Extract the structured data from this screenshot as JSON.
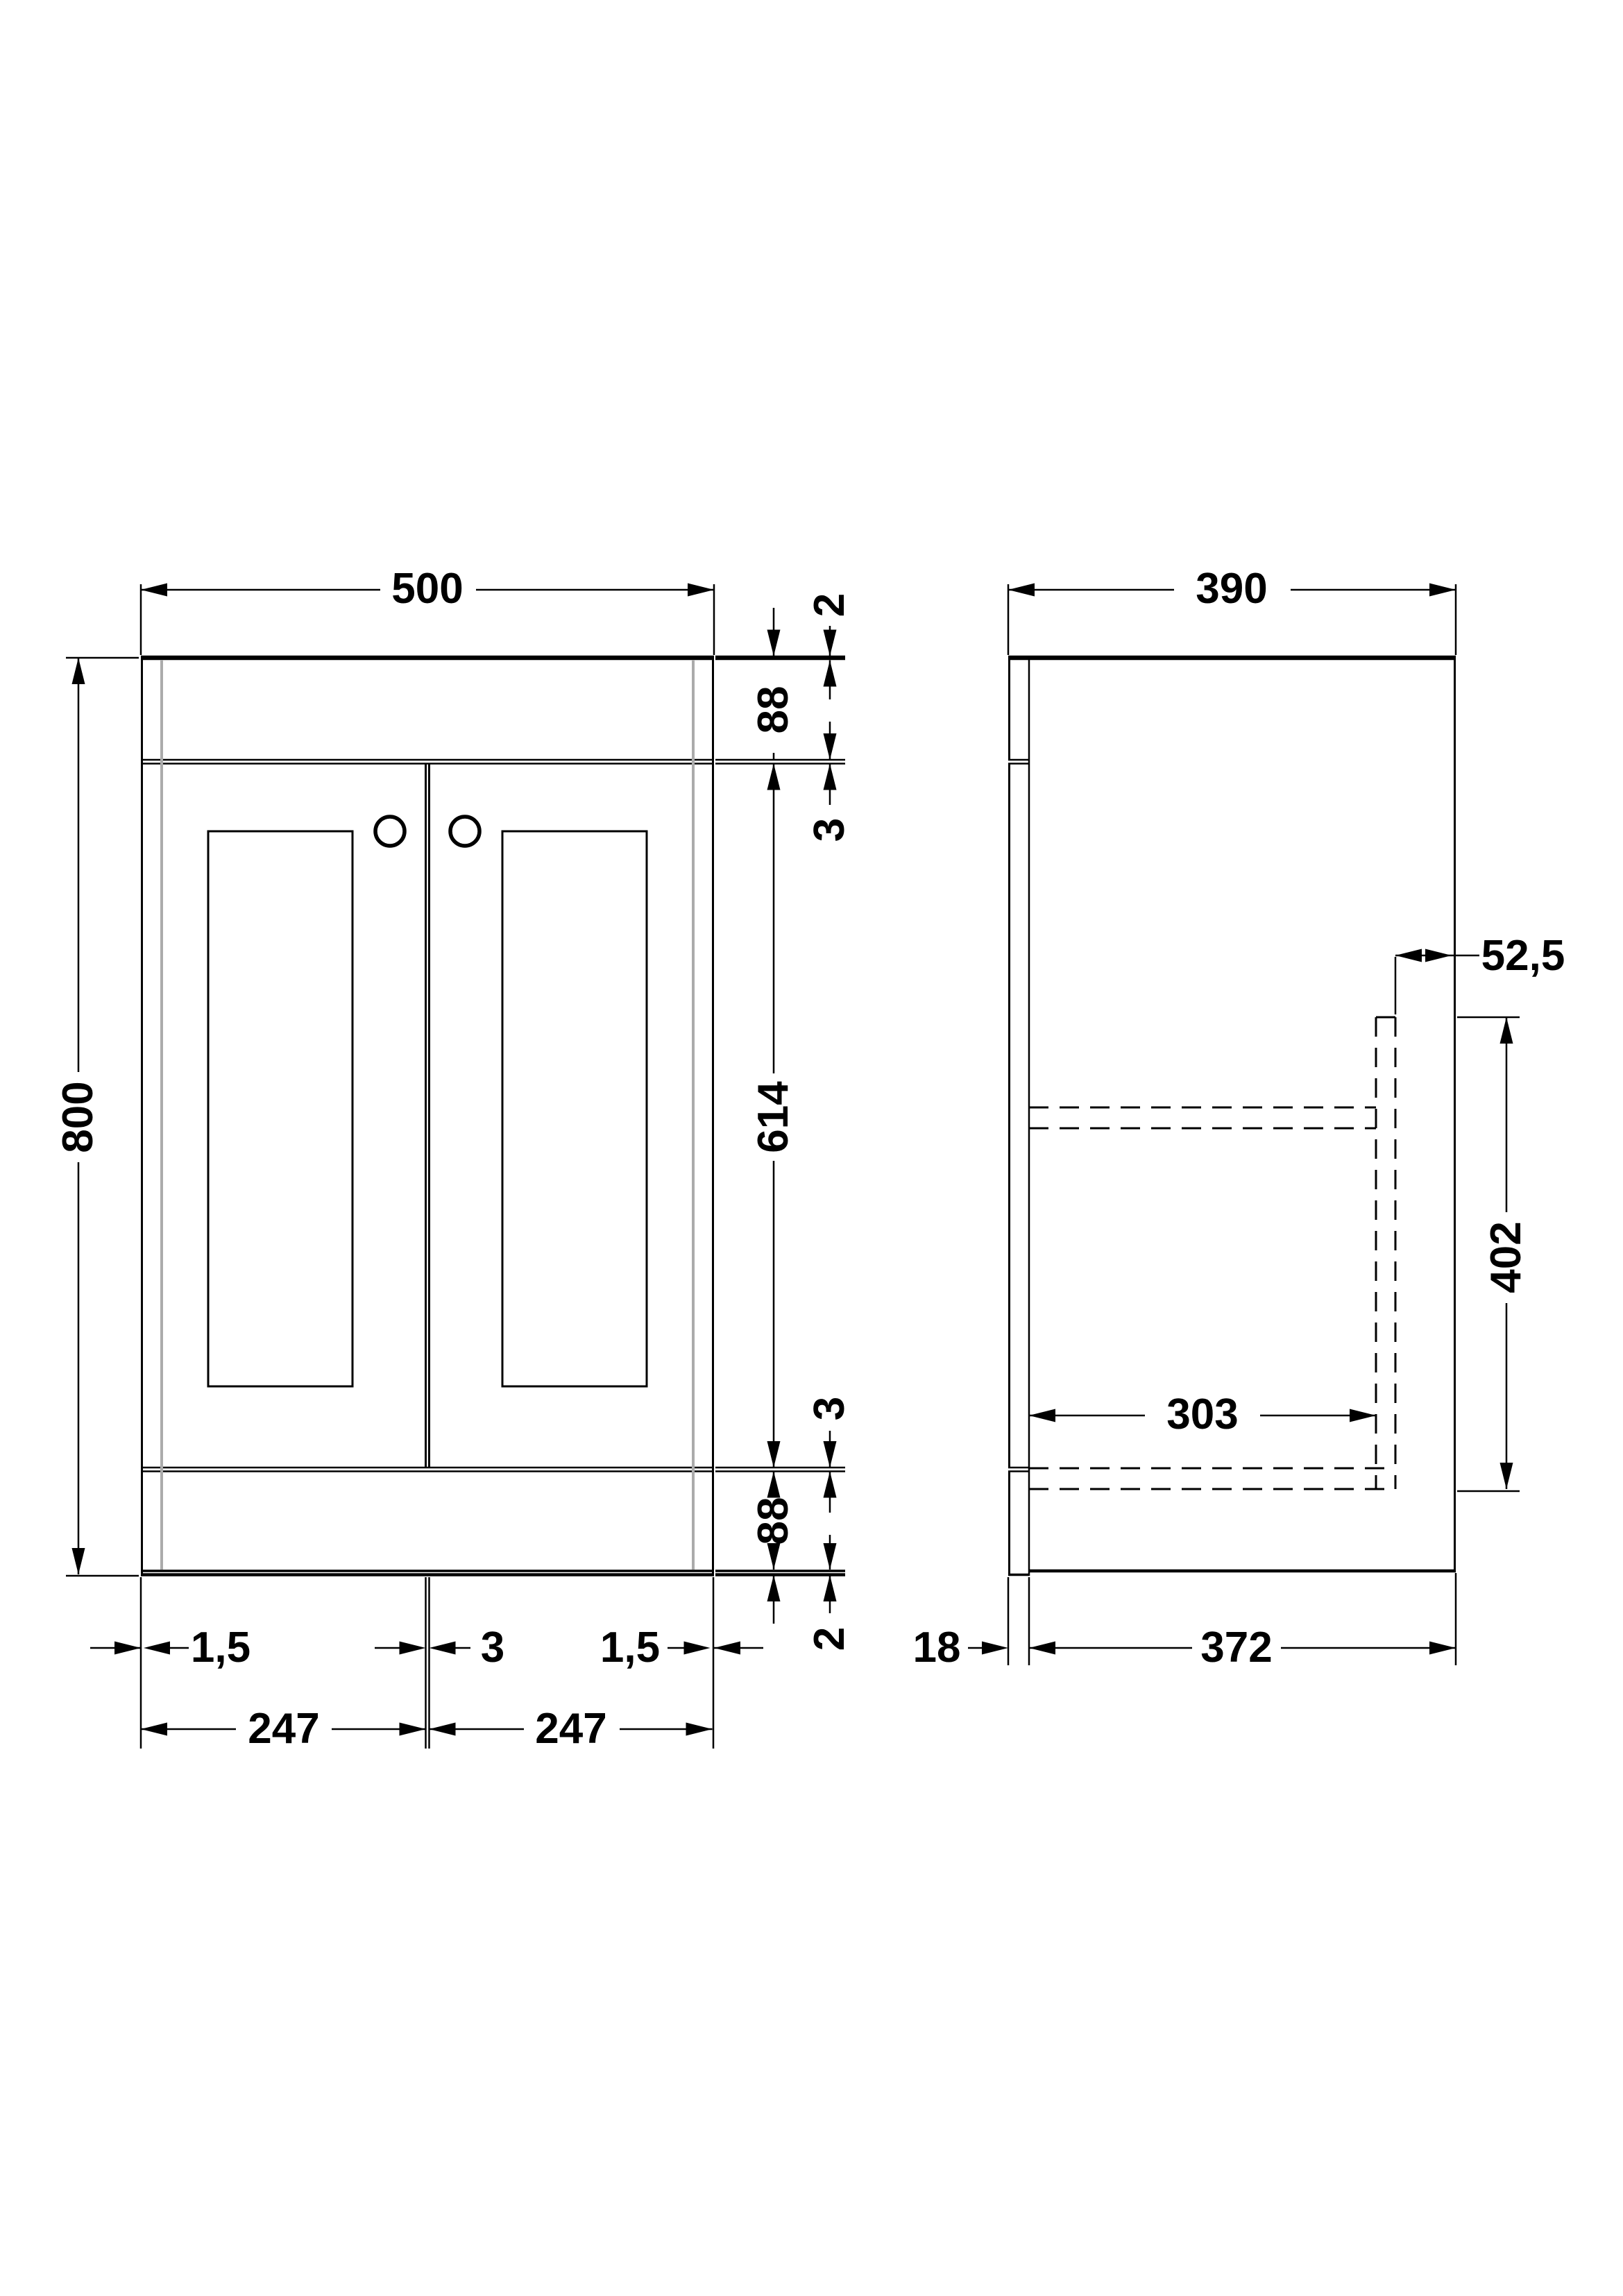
{
  "front_view": {
    "width": "500",
    "height": "800",
    "lip_top": "2",
    "rail_top": "88",
    "gap_top": "3",
    "door_height": "614",
    "gap_bottom": "3",
    "rail_bottom": "88",
    "lip_bottom": "2",
    "edge_gap_left": "1,5",
    "center_gap": "3",
    "edge_gap_right": "1,5",
    "door_left_width": "247",
    "door_right_width": "247"
  },
  "side_view": {
    "depth": "390",
    "back_offset": "52,5",
    "back_panel_height": "402",
    "internal_depth": "303",
    "front_thickness": "18",
    "body_depth": "372"
  },
  "colors": {
    "line": "#000000",
    "hidden_edge": "#ababab",
    "background": "#ffffff"
  }
}
